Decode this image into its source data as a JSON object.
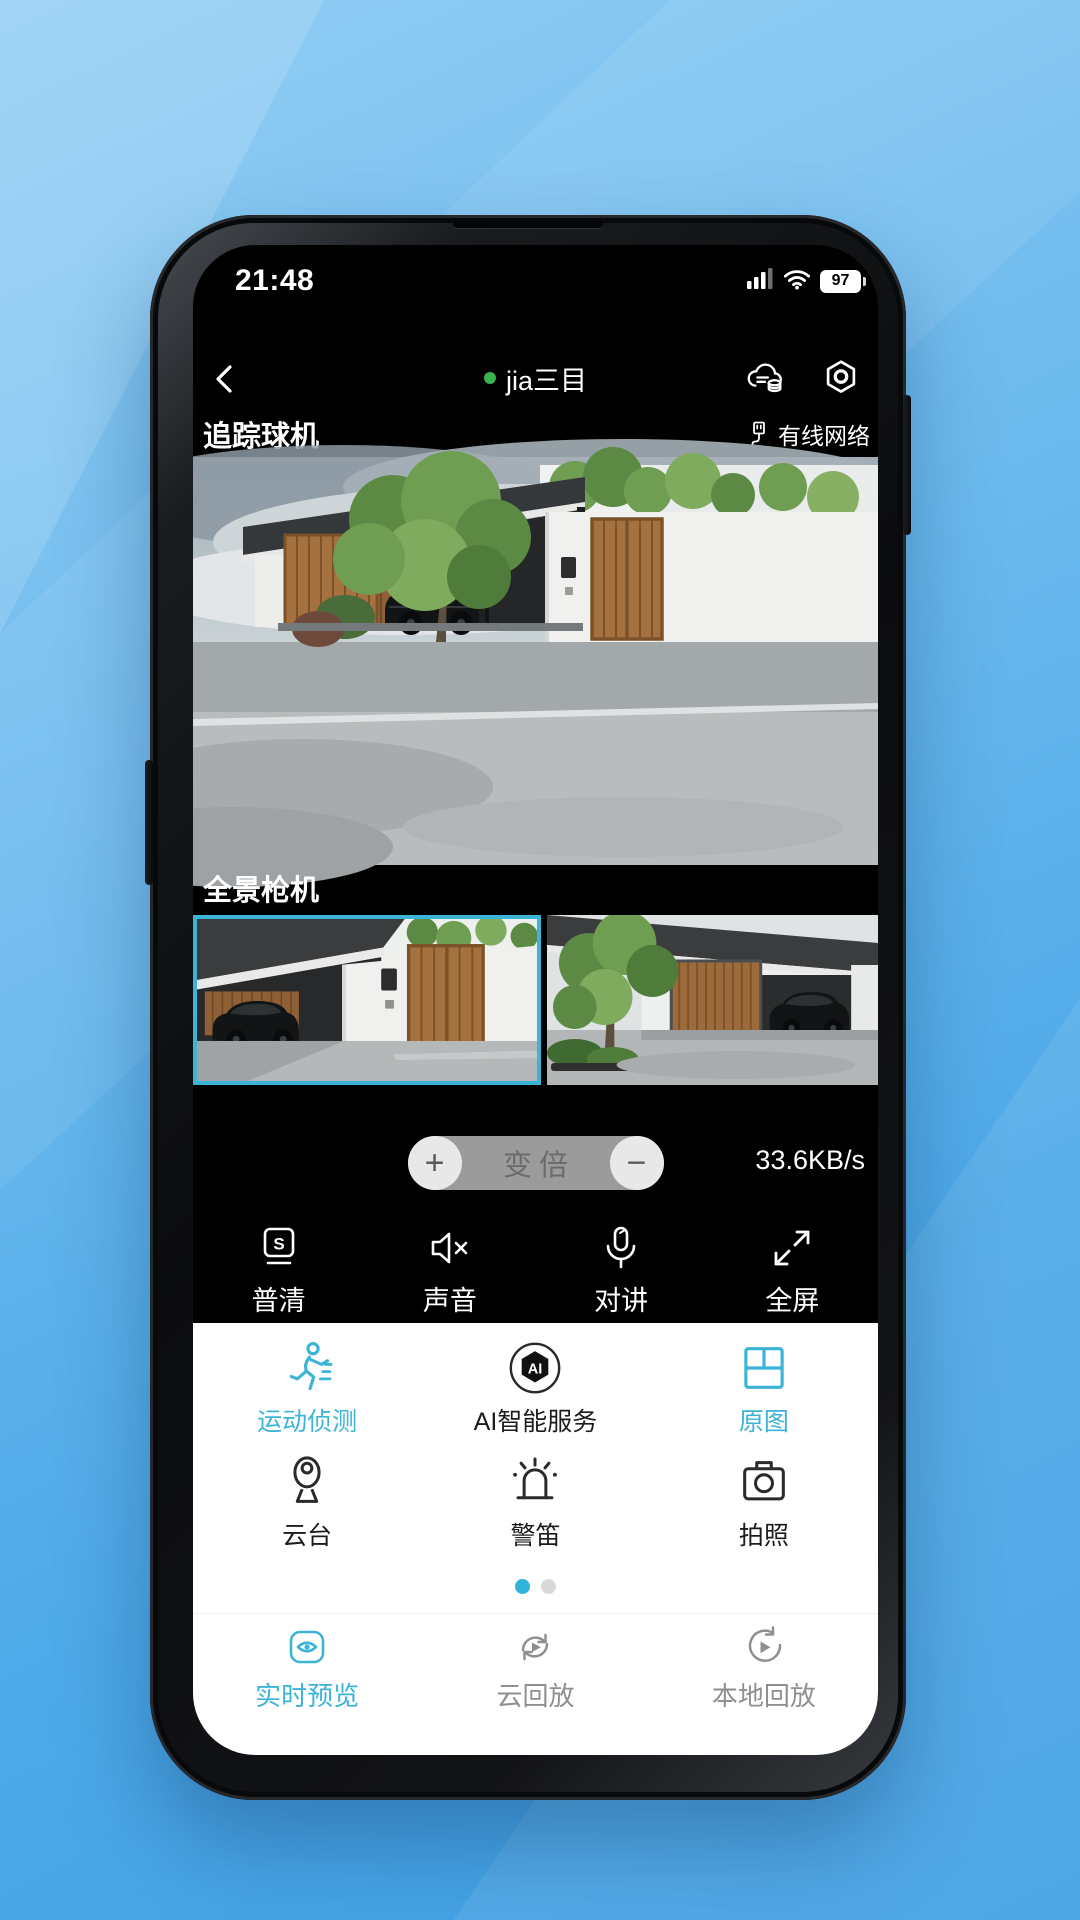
{
  "colors": {
    "accent": "#3bb4d8",
    "online_green": "#3cb04c"
  },
  "status_bar": {
    "time": "21:48",
    "battery_percent": "97"
  },
  "nav_bar": {
    "title": "jia三目"
  },
  "camera_sections": {
    "tracking_label": "追踪球机",
    "network_status": "有线网络",
    "panorama_label": "全景枪机",
    "bitrate": "33.6KB/s"
  },
  "zoom_control": {
    "plus": "+",
    "label": "变倍",
    "minus": "−"
  },
  "toolbar": {
    "items": [
      {
        "label": "普清",
        "icon": "sd-quality-icon",
        "icon_letter": "S"
      },
      {
        "label": "声音",
        "icon": "speaker-muted-icon"
      },
      {
        "label": "对讲",
        "icon": "microphone-icon"
      },
      {
        "label": "全屏",
        "icon": "fullscreen-icon"
      }
    ]
  },
  "function_panel": {
    "row1": [
      {
        "label": "运动侦测",
        "active": true
      },
      {
        "label": "AI智能服务",
        "active": false,
        "badge": "AI"
      },
      {
        "label": "原图",
        "active": true
      }
    ],
    "row2": [
      {
        "label": "云台"
      },
      {
        "label": "警笛"
      },
      {
        "label": "拍照"
      }
    ],
    "page_dots": {
      "current": 1,
      "total": 2
    }
  },
  "tab_bar": {
    "tabs": [
      {
        "label": "实时预览",
        "active": true
      },
      {
        "label": "云回放",
        "active": false
      },
      {
        "label": "本地回放",
        "active": false
      }
    ]
  }
}
